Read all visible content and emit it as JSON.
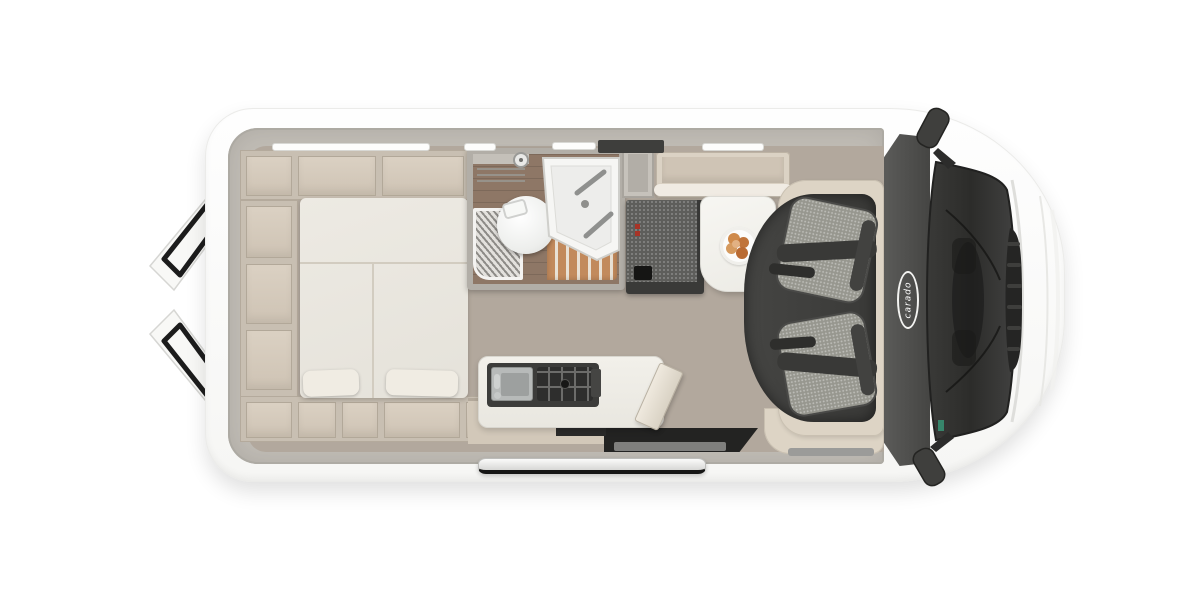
{
  "title": "Camper van top-view floor plan",
  "brand": {
    "logo_text": "carado"
  },
  "palette": {
    "background": "#ffffff",
    "body_white": "#fbfbfa",
    "wall_gray": "#c0bcb5",
    "furniture_beige": "#d8cec0",
    "mattress_white": "#eae7e0",
    "wood_floor": "#b2a89d",
    "bathroom_wood": "#8e7766",
    "shower_slats": "#c28a5c",
    "dark_upholstery": "#5c5c59",
    "seat_fabric": "#9b9b96",
    "cab_band": "#4e4e4c",
    "table_white": "#f4f3ef",
    "food_orange": "#cf8a4b",
    "glass_dark": "#323230",
    "door_trim_black": "#1c1c1c"
  }
}
